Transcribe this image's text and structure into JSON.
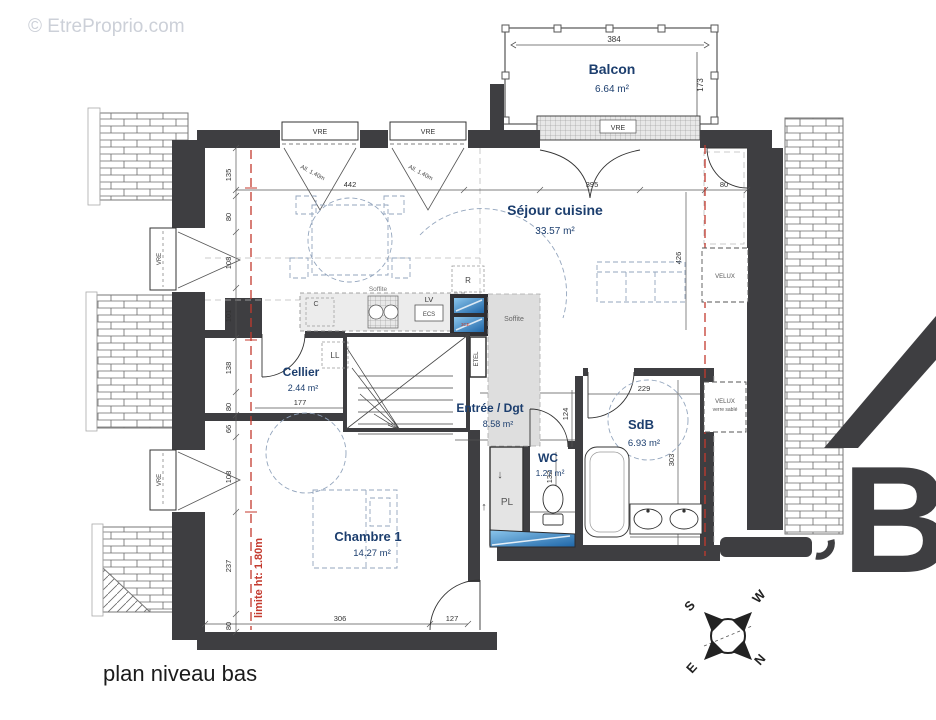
{
  "meta": {
    "watermark": "© EtreProprio.com",
    "title": "plan niveau bas",
    "logo_letter": "B"
  },
  "rooms": {
    "balcon": {
      "name": "Balcon",
      "area": "6.64 m²"
    },
    "sejour": {
      "name": "Séjour cuisine",
      "area": "33.57 m²"
    },
    "cellier": {
      "name": "Cellier",
      "area": "2.44 m²"
    },
    "entree": {
      "name": "Entrée / Dgt",
      "area": "8.58 m²"
    },
    "wc": {
      "name": "WC",
      "area": "1.27 m²"
    },
    "sdb": {
      "name": "SdB",
      "area": "6.93 m²"
    },
    "chambre": {
      "name": "Chambre 1",
      "area": "14.27 m²"
    }
  },
  "labels": {
    "vre": "VRE",
    "allege": "All. 1.40m",
    "r": "R",
    "c": "C",
    "lv": "LV",
    "ecs": "ECS",
    "ll": "LL",
    "pl": "PL",
    "etel": "ETEL",
    "soffite": "Soffite",
    "velux": "VELUX",
    "verre_sable": "verre sablé",
    "limite": "limite ht: 1.80m",
    "cote_3ce": "3CE",
    "arrow_down": "↓",
    "arrow_up": "↑"
  },
  "compass": {
    "n": "N",
    "s": "S",
    "e": "E",
    "w": "W"
  },
  "dims": {
    "balcon_w": "384",
    "balcon_h": "173",
    "sejour_w": "442",
    "sejour_door": "395",
    "right_top": "80",
    "right_h": "426",
    "left_chain": [
      "135",
      "80",
      "108",
      "101",
      "138",
      "80",
      "66",
      "108",
      "237",
      "80"
    ],
    "kitchen": "357",
    "stairs": "218",
    "cellier": "177",
    "entree_top": "236",
    "entree_h": "124",
    "entree_w": "293",
    "wc_door": "96",
    "wc_w": "132",
    "sdb_w": "229",
    "sdb_h": "303",
    "sdb_sinks": "229",
    "chambre_w": "306",
    "chambre_door": "127"
  },
  "colors": {
    "wall": "#3e3e41",
    "label": "#1c3e6e",
    "red": "#c43a2e",
    "glass": "#4da0dc"
  }
}
